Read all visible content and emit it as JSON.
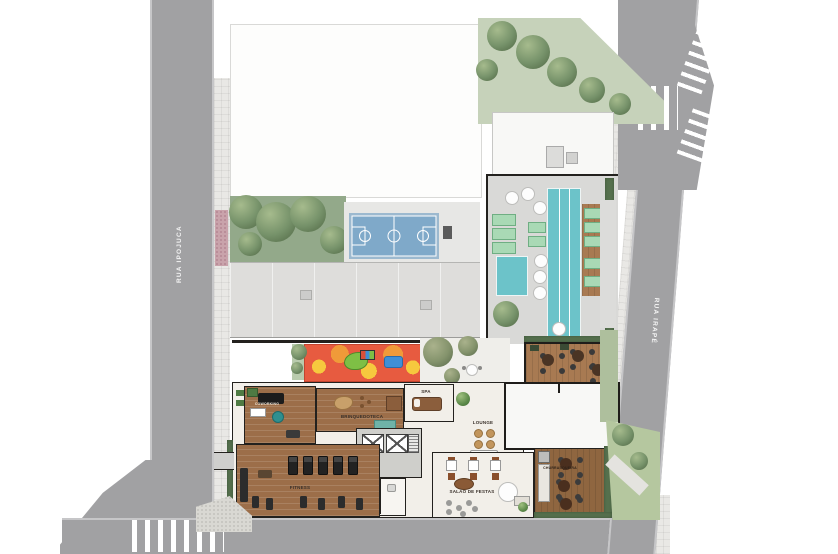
{
  "streets": {
    "left": "RUA IPOJUCA",
    "right": "RUA IRAPÉ"
  },
  "rooms": {
    "coworking": "COWORKING",
    "fitness": "FITNESS",
    "brinquedoteca": "BRINQUEDOTECA",
    "spa": "SPA",
    "lounge": "LOUNGE",
    "salao_de_festas": "SALÃO DE FESTAS",
    "churrasqueira": "CHURRASQUEIRA"
  },
  "features": [
    "lap-pool",
    "kids-pool",
    "pool-deck",
    "sun-loungers",
    "umbrella-tables",
    "sports-court",
    "playground",
    "garden",
    "barbecue-deck",
    "party-room",
    "elevator-core",
    "crosswalks",
    "sidewalks",
    "rooftop"
  ],
  "colors": {
    "street": "#a1a1a3",
    "sidewalk": "#e9e8e5",
    "pool": "#6cc3c9",
    "court": "#7fa9c9",
    "wood_floor": "#9c6e49",
    "deck_wood": "#a87a52",
    "lawn": "#c6d2ba",
    "garden": "#93a98a",
    "hedge": "#56714e",
    "playground_red": "#e75b40",
    "playground_yellow": "#f6c93e",
    "roof_gray": "#dedddb",
    "roof_white": "#f8f8f6",
    "wall": "#23211e",
    "floor": "#f2efe9"
  }
}
